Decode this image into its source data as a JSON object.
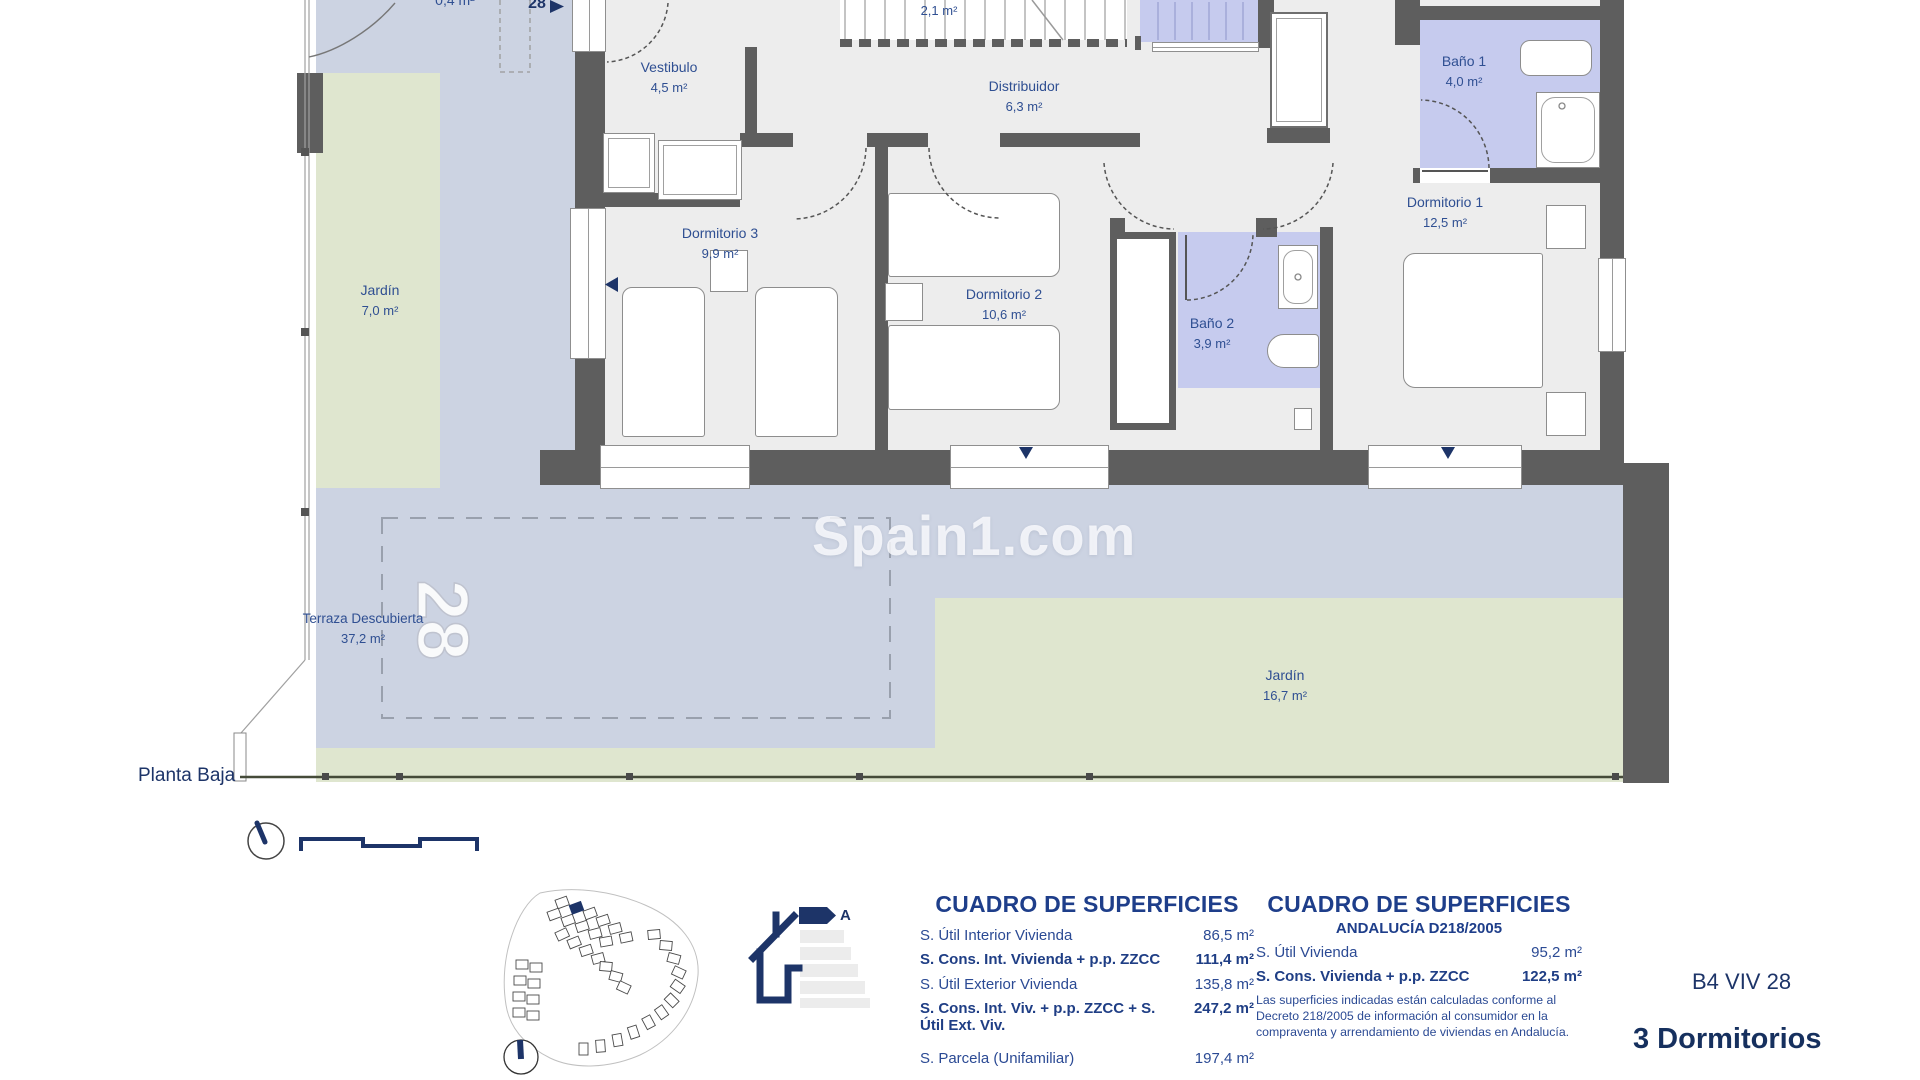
{
  "floor_label": "Planta Baja",
  "watermark": "Spain1.com",
  "unit": {
    "marker": "28",
    "parcel_number": "28",
    "code": "B4 VIV 28",
    "type": "3 Dormitorios"
  },
  "rooms": {
    "vestibulo": {
      "name": "Vestibulo",
      "area": "4,5 m²"
    },
    "distribuidor": {
      "name": "Distribuidor",
      "area": "6,3 m²"
    },
    "escalera": {
      "area": "2,1 m²"
    },
    "bano1": {
      "name": "Baño 1",
      "area": "4,0 m²"
    },
    "bano2": {
      "name": "Baño 2",
      "area": "3,9 m²"
    },
    "dormitorio1": {
      "name": "Dormitorio 1",
      "area": "12,5 m²"
    },
    "dormitorio2": {
      "name": "Dormitorio 2",
      "area": "10,6 m²"
    },
    "dormitorio3": {
      "name": "Dormitorio 3",
      "area": "9,9 m²"
    },
    "porche": {
      "area": "0,4 m²"
    }
  },
  "exterior": {
    "jardin_norte": {
      "name": "Jardín",
      "area": "7,0 m²"
    },
    "jardin_sur": {
      "name": "Jardín",
      "area": "16,7 m²"
    },
    "terraza": {
      "name": "Terraza Descubierta",
      "area": "37,2 m²"
    }
  },
  "tables": {
    "superficies": {
      "title": "CUADRO DE SUPERFICIES",
      "rows": [
        {
          "label": "S. Útil Interior Vivienda",
          "value": "86,5 m²"
        },
        {
          "label": "S. Cons. Int. Vivienda + p.p. ZZCC",
          "value": "111,4 m²"
        },
        {
          "label": "S. Útil Exterior Vivienda",
          "value": "135,8 m²"
        },
        {
          "label": "S. Cons. Int. Viv. + p.p. ZZCC + S. Útil Ext. Viv.",
          "value": "247,2 m²"
        },
        {
          "label": "S. Parcela (Unifamiliar)",
          "value": "197,4 m²"
        }
      ]
    },
    "superficies_andalucia": {
      "title": "CUADRO DE SUPERFICIES",
      "subtitle": "ANDALUCÍA D218/2005",
      "rows": [
        {
          "label": "S. Útil Vivienda",
          "value": "95,2 m²"
        },
        {
          "label": "S. Cons. Vivienda + p.p. ZZCC",
          "value": "122,5 m²"
        }
      ],
      "note": "Las superficies indicadas están calculadas conforme al Decreto 218/2005 de información al consumidor en la compraventa y arrendamiento de viviendas en Andalucía."
    }
  },
  "energy": {
    "rating": "A"
  },
  "colors": {
    "wall": "#5e5e5e",
    "floor": "#ededed",
    "terrace": "#ccd3e2",
    "bathroom": "#c6cbee",
    "garden": "#dfe6cf",
    "navy": "#1d3468"
  }
}
